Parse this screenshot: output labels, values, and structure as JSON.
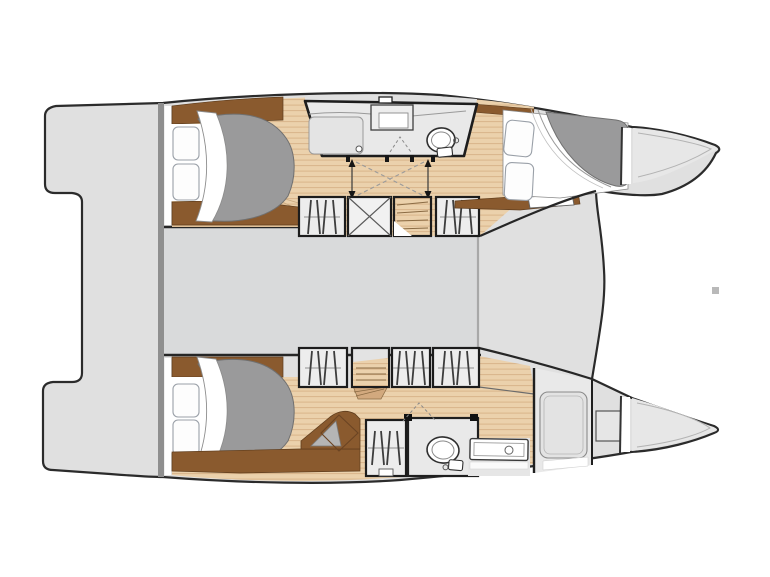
{
  "page": {
    "background": "#ffffff",
    "description": "Catamaran yacht interior floor plan, top view, bows pointing right"
  },
  "colors": {
    "hull": "#e0e0e0",
    "hull_light": "#e7e7e7",
    "bridgedeck": "#d9dadb",
    "outline": "#2b2b2b",
    "divider": "#8f8f8f",
    "wood_base": "#ebd1ac",
    "wood_line": "#d9b48a",
    "wood_step": "#d2a97e",
    "trim_brown": "#8a5a2e",
    "trim_brown_dark": "#5f3d1d",
    "duvet": "#9a9a9b",
    "room": "#e9e9e9",
    "locker": "#ededed",
    "white": "#ffffff",
    "hanger": "#3d3d3d",
    "watermark": "#b9b9b9"
  },
  "plan": {
    "type": "yacht-floor-plan",
    "vessel": "catamaran",
    "orientation": "bow-right",
    "hulls": [
      {
        "name": "port-hull",
        "position": "top",
        "rooms": [
          "aft-double-cabin",
          "en-suite-shower-room",
          "hanging-lockers",
          "companionway-steps",
          "forward-double-cabin",
          "bow-locker"
        ]
      },
      {
        "name": "starboard-hull",
        "position": "bottom",
        "rooms": [
          "aft-double-cabin",
          "dressing-desk",
          "hanging-locker",
          "toilet-compartment",
          "vanity-sink",
          "shower-stall",
          "forward-storage",
          "bow-locker"
        ]
      }
    ],
    "shared_areas": [
      "aft-transom-platform",
      "bridgedeck-saloon",
      "foredeck",
      "trampoline-opening"
    ]
  }
}
